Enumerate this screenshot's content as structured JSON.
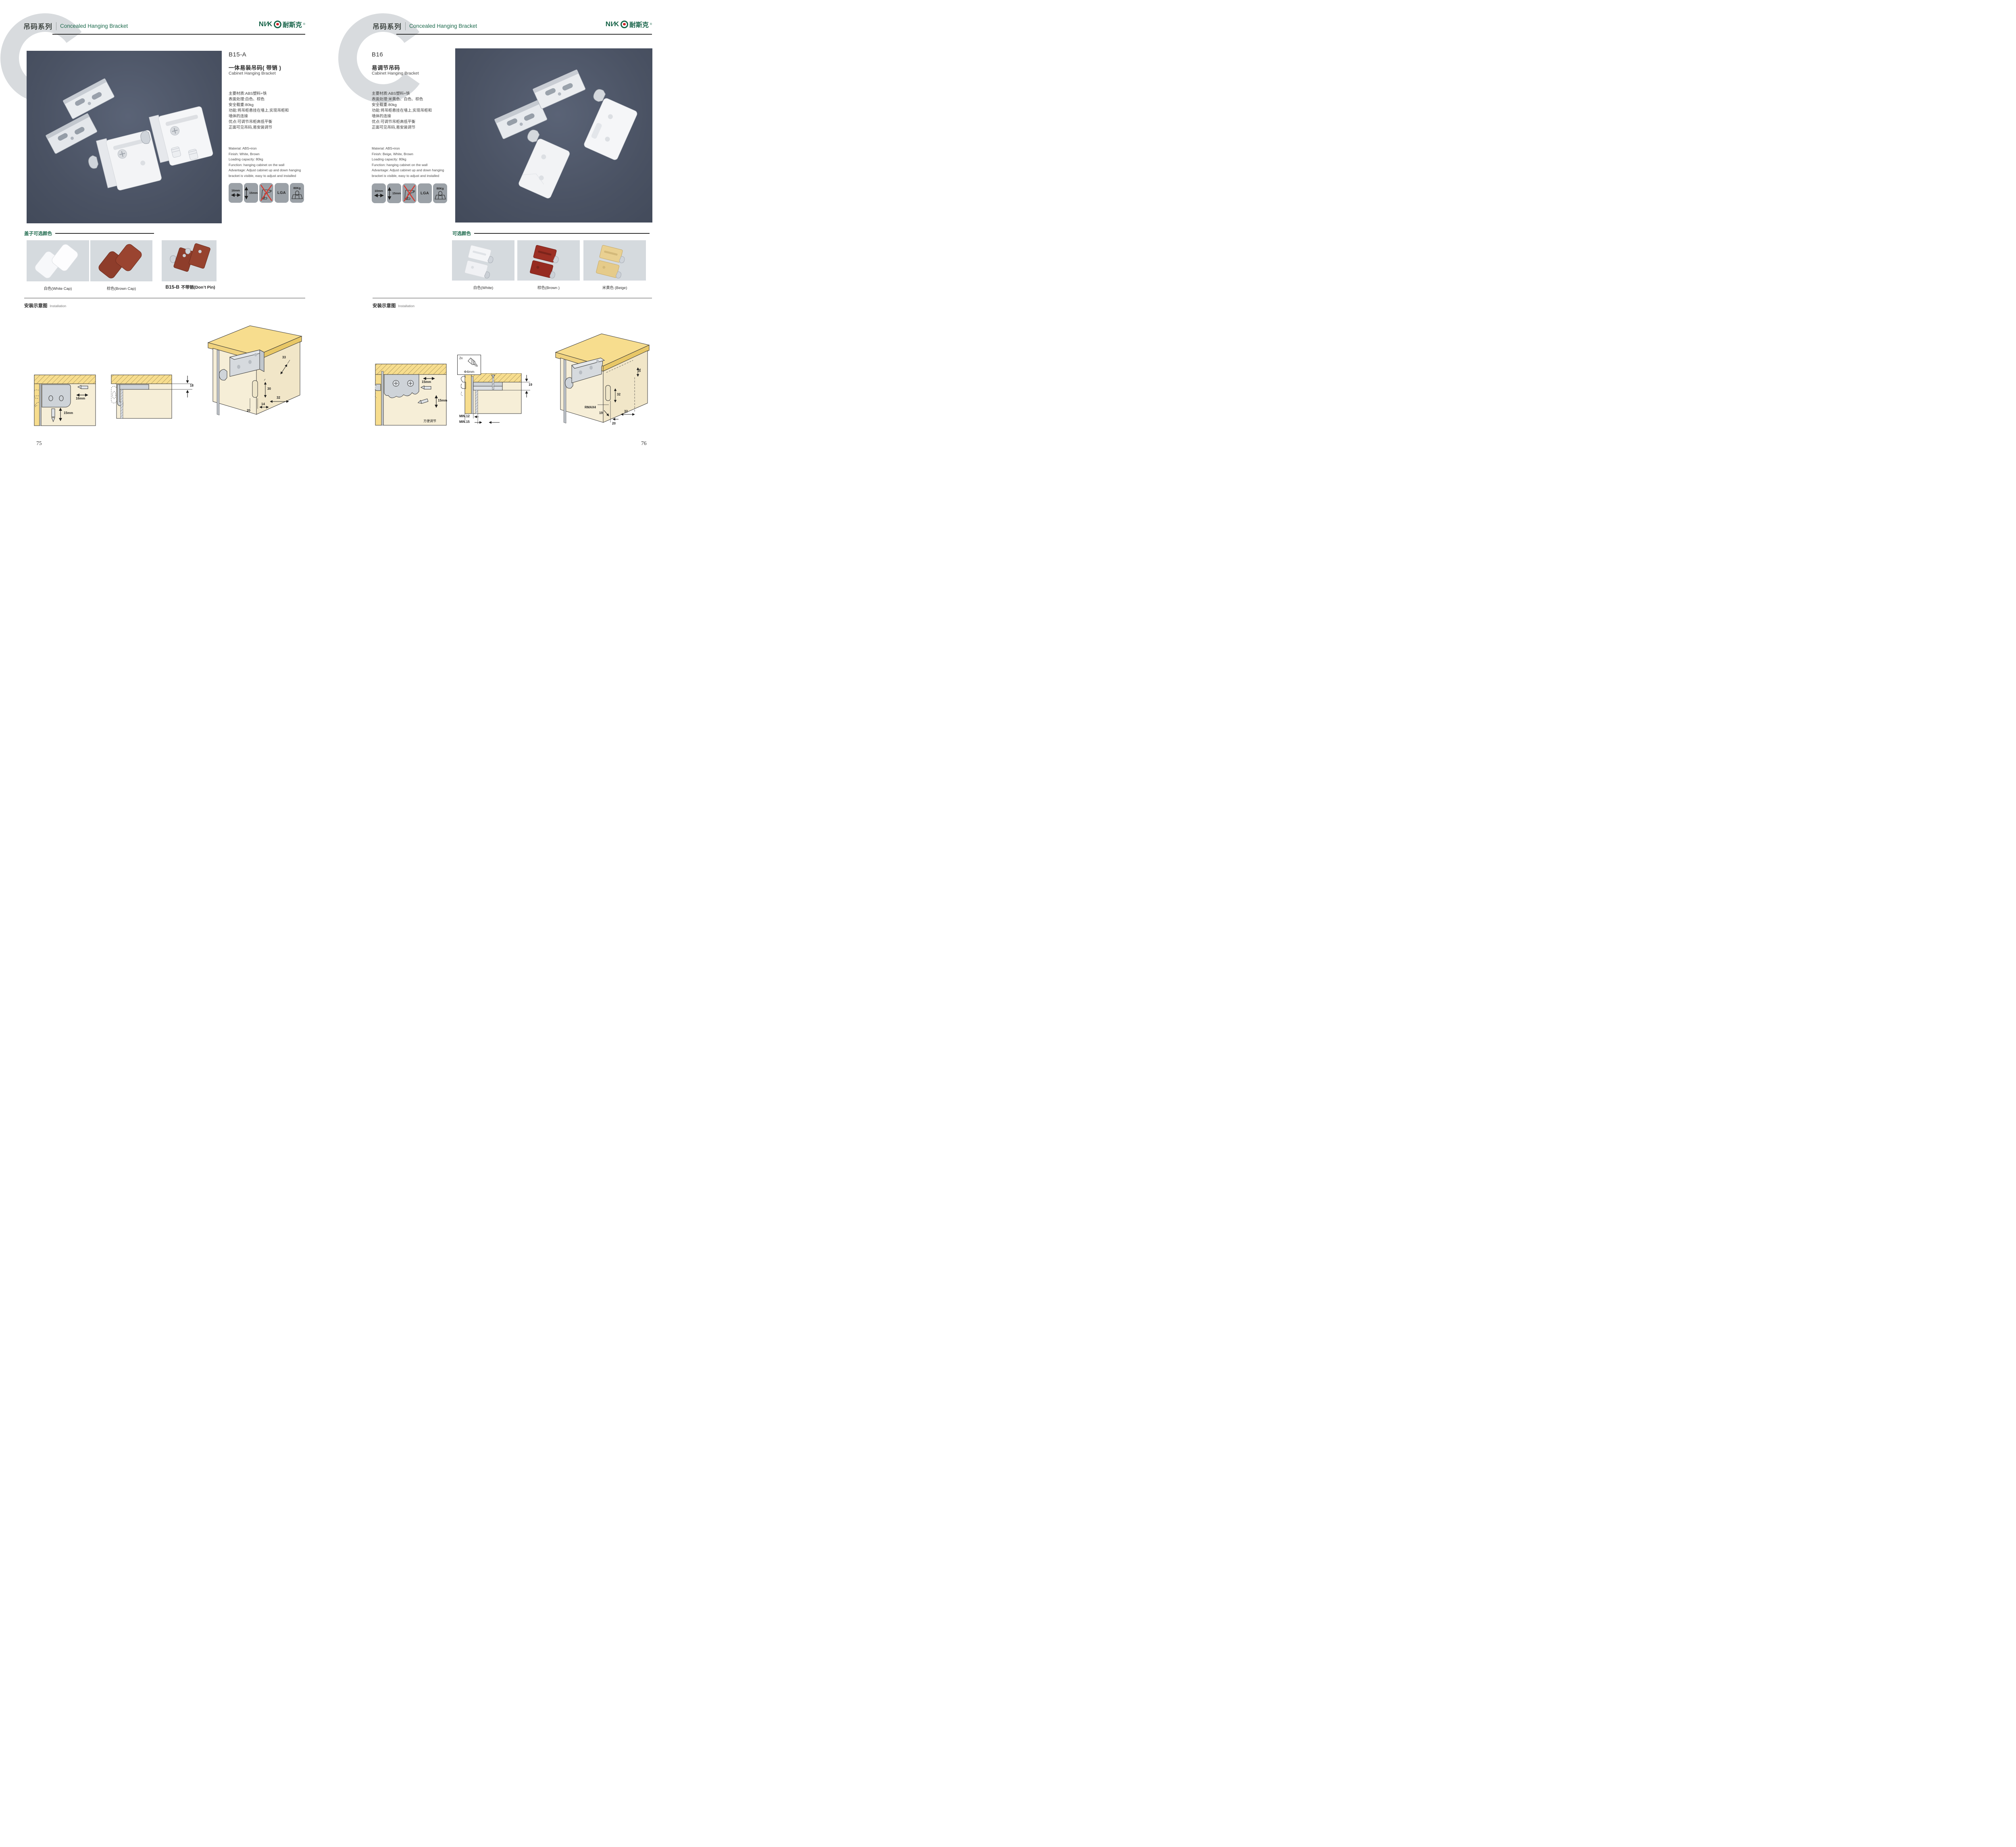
{
  "brand": {
    "logo_latin": "NI∕K",
    "logo_cn": "耐斯克",
    "reg": "®"
  },
  "left": {
    "header": {
      "series_cn": "吊码系列",
      "series_en": "Concealed Hanging Bracket"
    },
    "code": "B15-A",
    "title_cn": "一体易装吊码( 带销 )",
    "title_en": "Cabinet Hanging Bracket",
    "specs_cn": [
      "主要材质:ABS塑料+铁",
      "表面处理:白色、棕色",
      "安全载重:80kg",
      "功能:将吊柜悬挂在墙上,实现吊柜和",
      "墙体的连接",
      "优点:可调节吊柜高低平衡",
      "正面可见吊码,易安装调节"
    ],
    "specs_en": [
      "Material: ABS+iron",
      "Finish: White, Brown",
      "Loading capacity: 80kg",
      "Function: hanging cabinet on the wall",
      "Advantage: Adjust cabinet up and down hanging",
      "bracket is visible, easy to adjust and installed"
    ],
    "icons": {
      "w": "16mm",
      "h": "15mm",
      "cert": "LGA",
      "load": "80Kg"
    },
    "color_heading": "盖子可选颜色",
    "swatches": [
      {
        "label": "白色(White Cap)"
      },
      {
        "label": "棕色(Brown Cap)"
      },
      {
        "code": "B15-B",
        "label": "不带销(Don’t Pin)"
      }
    ],
    "install": {
      "cn": "安装示意图",
      "en": "Installation"
    },
    "d1": {
      "w": "16mm",
      "h": "15mm"
    },
    "d2": {
      "h": "18"
    },
    "d3": {
      "a": "33",
      "b": "30",
      "c": "32",
      "d": "20",
      "e": "14"
    },
    "page_no": "75"
  },
  "right": {
    "header": {
      "series_cn": "吊码系列",
      "series_en": "Concealed Hanging Bracket"
    },
    "code": "B16",
    "title_cn": "易调节吊码",
    "title_en": "Cabinet Hanging Bracket",
    "specs_cn": [
      "主要材质:ABS塑料+铁",
      "表面处理:米黄色、白色、棕色",
      "安全载重:80kg",
      "功能:将吊柜悬挂在墙上,实现吊柜和",
      "墙体的连接",
      "优点:可调节吊柜高低平衡",
      "正面可见吊码,易安装调节"
    ],
    "specs_en": [
      "Material: ABS+iron",
      "Finish: Beige, White, Brown",
      "Loading capacity: 80kg",
      "Function: hanging cabinet on the wall",
      "Advantage: Adjust cabinet up and down hanging",
      "bracket is visible, easy to adjust and installed"
    ],
    "icons": {
      "w": "10mm",
      "h": "15mm",
      "cert": "LGA",
      "load": "80Kg"
    },
    "color_heading": "可选颜色",
    "swatches": [
      {
        "label": "白色(White)"
      },
      {
        "label": "棕色(Brown )"
      },
      {
        "label": "米黄色 (Beige)"
      }
    ],
    "install": {
      "cn": "安装示意图",
      "en": "Installation"
    },
    "d1": {
      "w": "15mm",
      "h": "15mm",
      "note": "方便调节"
    },
    "screw": {
      "count": "2x",
      "dia": "Φ4mm"
    },
    "d2": {
      "h": "19",
      "min1": "MIN.12",
      "min2": "MIN.15"
    },
    "d3": {
      "a": "30",
      "b": "32",
      "c": "RMAX4",
      "d": "19",
      "e": "20",
      "f": "32"
    },
    "page_no": "76"
  }
}
